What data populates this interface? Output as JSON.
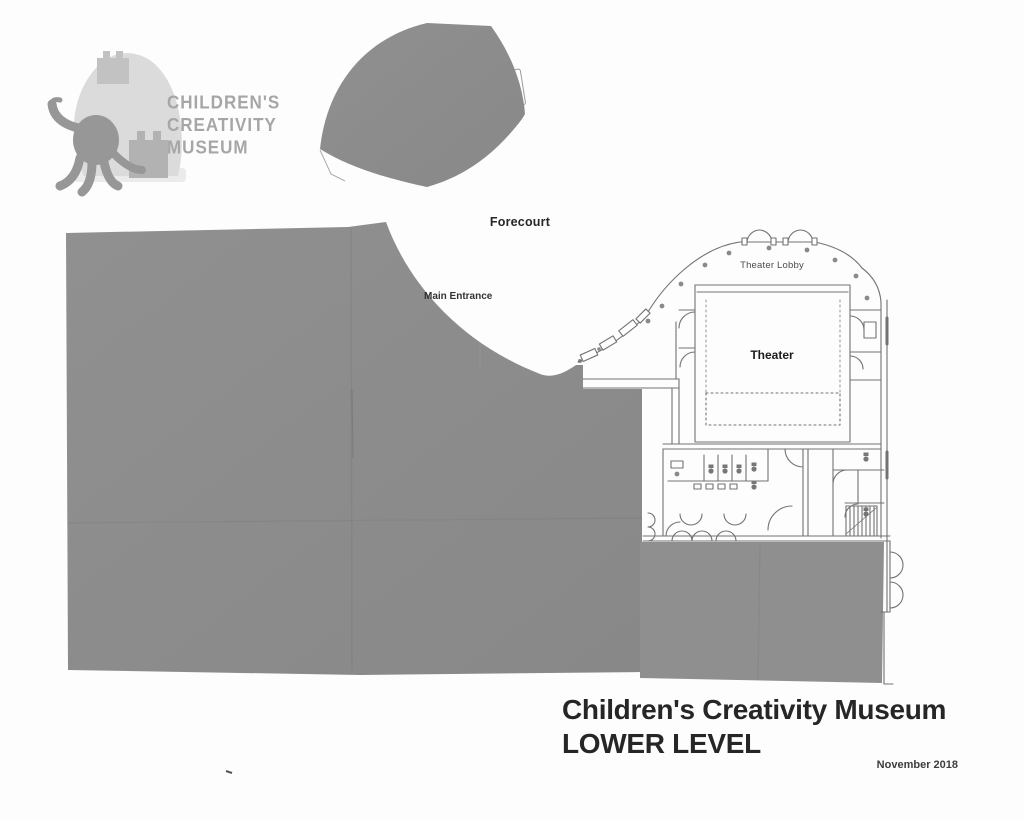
{
  "document": {
    "kind": "scanned-floor-plan",
    "background_color": "#fdfdfd"
  },
  "logo": {
    "wordmark": [
      "CHILDREN'S",
      "CREATIVITY",
      "MUSEUM"
    ],
    "text_color": "#a6a6a6",
    "octopus_icon": "octopus-silhouette",
    "buildings_icon": "museum-buildings-silhouette"
  },
  "plan": {
    "labels": {
      "forecourt": "Forecourt",
      "main_entrance": "Main Entrance",
      "theater_lobby": "Theater Lobby",
      "theater": "Theater"
    },
    "redaction_color": "#8d8d8d",
    "line_color": "#727272"
  },
  "footer": {
    "title": "Children's Creativity Museum",
    "subtitle": "LOWER LEVEL",
    "date": "November 2018"
  }
}
